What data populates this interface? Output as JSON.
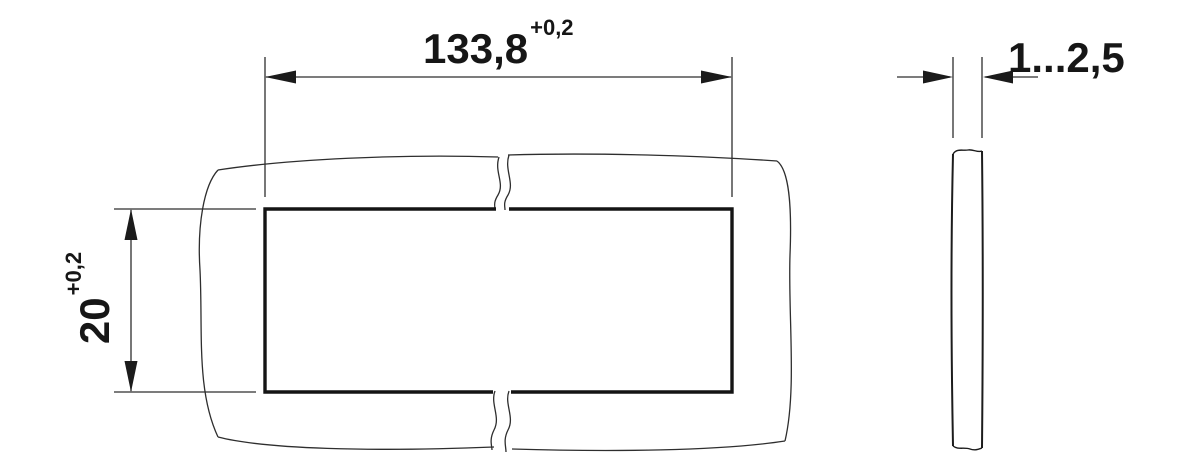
{
  "labels": {
    "width": {
      "value": "133,8",
      "tolerance": "+0,2"
    },
    "height": {
      "value": "20",
      "tolerance": "+0,2"
    },
    "thickness": {
      "value": "1...2,5"
    }
  },
  "colors": {
    "thin_line": "#2e2e2e",
    "thick_line": "#141414",
    "side_view_line": "#1c1c1c",
    "background": "#ffffff"
  }
}
